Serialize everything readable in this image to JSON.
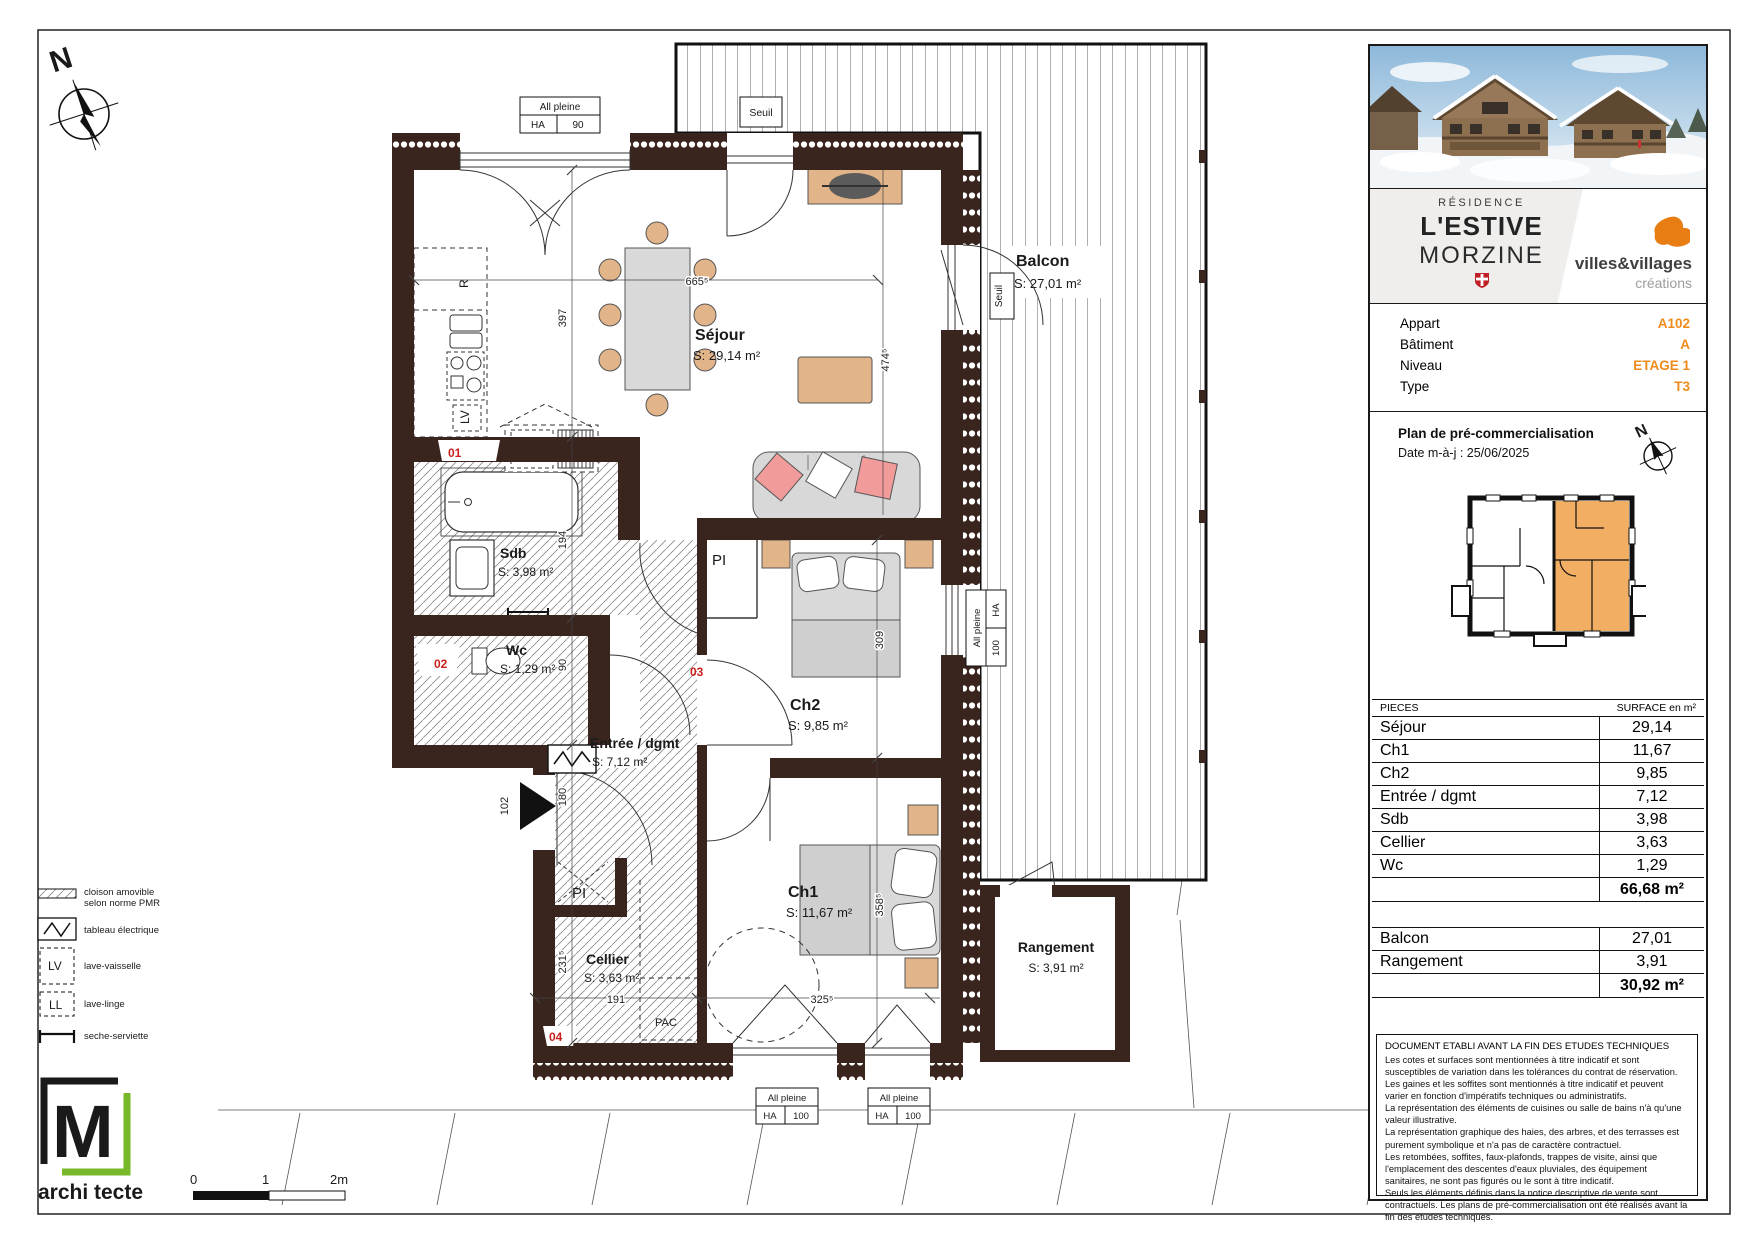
{
  "colors": {
    "wall": "#3a241e",
    "accent_orange": "#ef8b1b",
    "mini_highlight": "#f2ae63",
    "logo_green": "#76b82a",
    "furniture_tan": "#e2b489",
    "cushion_pink": "#f29b9b",
    "tag_red": "#c9201d"
  },
  "compass": {
    "n": "N"
  },
  "plan": {
    "rooms": [
      {
        "name": "Séjour",
        "area": "S: 29,14 m²"
      },
      {
        "name": "Balcon",
        "area": "S: 27,01 m²"
      },
      {
        "name": "Sdb",
        "area": "S: 3,98 m²"
      },
      {
        "name": "Wc",
        "area": "S: 1,29 m²"
      },
      {
        "name": "Entrée / dgmt",
        "area": "S: 7,12 m²"
      },
      {
        "name": "Ch2",
        "area": "S: 9,85 m²"
      },
      {
        "name": "Ch1",
        "area": "S: 11,67 m²"
      },
      {
        "name": "Cellier",
        "area": "S: 3,63 m²"
      },
      {
        "name": "Rangement",
        "area": "S: 3,91 m²"
      }
    ],
    "dims": {
      "sejour_w": "665⁵",
      "sejour_h": "397",
      "sejour_e": "474⁵",
      "sdb": "194",
      "wc": "90",
      "entree": "180",
      "cellier_h": "231⁵",
      "cellier_w": "191",
      "ch2": "309",
      "ch1_h": "358⁵",
      "ch1_w": "325⁵",
      "entry": "102"
    },
    "labels": {
      "seuil": "Seuil",
      "all_pleine": "All pleine",
      "ha": "HA",
      "h90": "90",
      "h100": "100",
      "pl": "PI",
      "pac": "PAC",
      "lv": "LV",
      "r": "R"
    },
    "tags": {
      "t01": "01",
      "t02": "02",
      "t03": "03",
      "t04": "04"
    }
  },
  "legend": {
    "items": [
      {
        "label1": "cloison amovible",
        "label2": "selon norme PMR"
      },
      {
        "label1": "tableau électrique"
      },
      {
        "sym": "LV",
        "label1": "lave-vaisselle"
      },
      {
        "sym": "LL",
        "label1": "lave-linge"
      },
      {
        "label1": "seche-serviette"
      }
    ]
  },
  "scalebar": {
    "t0": "0",
    "t1": "1",
    "t2": "2m"
  },
  "logo": {
    "letter": "M",
    "green": "archi",
    "dark": "tecte"
  },
  "sidebar": {
    "brand": {
      "residence": "RÉSIDENCE",
      "name": "L'ESTIVE",
      "city": "MORZINE",
      "company": "villes&villages",
      "company_sub": "créations"
    },
    "info": {
      "rows": [
        {
          "label": "Appart",
          "value": "A102"
        },
        {
          "label": "Bâtiment",
          "value": "A"
        },
        {
          "label": "Niveau",
          "value": "ETAGE 1"
        },
        {
          "label": "Type",
          "value": "T3"
        }
      ]
    },
    "plan_section": {
      "title": "Plan de pré-commercialisation",
      "date": "Date m-à-j : 25/06/2025"
    },
    "surface_table": {
      "header_left": "PIECES",
      "header_right": "SURFACE en m²",
      "rows": [
        {
          "label": "Séjour",
          "value": "29,14"
        },
        {
          "label": "Ch1",
          "value": "11,67"
        },
        {
          "label": "Ch2",
          "value": "9,85"
        },
        {
          "label": "Entrée / dgmt",
          "value": "7,12"
        },
        {
          "label": "Sdb",
          "value": "3,98"
        },
        {
          "label": "Cellier",
          "value": "3,63"
        },
        {
          "label": "Wc",
          "value": "1,29"
        }
      ],
      "total": "66,68 m²"
    },
    "annex_table": {
      "rows": [
        {
          "label": "Balcon",
          "value": "27,01"
        },
        {
          "label": "Rangement",
          "value": "3,91"
        }
      ],
      "total": "30,92 m²"
    },
    "legal": {
      "title": "DOCUMENT ETABLI AVANT LA FIN DES ETUDES TECHNIQUES",
      "paragraphs": [
        "Les cotes et surfaces sont mentionnées à titre indicatif et sont susceptibles de variation dans les tolérances du contrat de réservation. Les gaines et les soffites sont mentionnés à titre indicatif et peuvent varier en fonction d'impératifs techniques ou administratifs.",
        "La représentation des éléments de cuisines ou salle de bains n'à qu'une valeur illustrative.",
        "La représentation graphique des haies, des arbres, et des terrasses est purement symbolique et n'a pas de caractère contractuel.",
        "Les retombées, soffites, faux-plafonds, trappes de visite, ainsi que l'emplacement des descentes d'eaux pluviales, des équipement sanitaires, ne sont pas figurés ou le sont à titre indicatif.",
        "Seuls les éléments définis dans la notice descriptive de vente sont contractuels. Les plans de pré-commercialisation ont été réalisés avant la fin des études techniques."
      ]
    }
  }
}
